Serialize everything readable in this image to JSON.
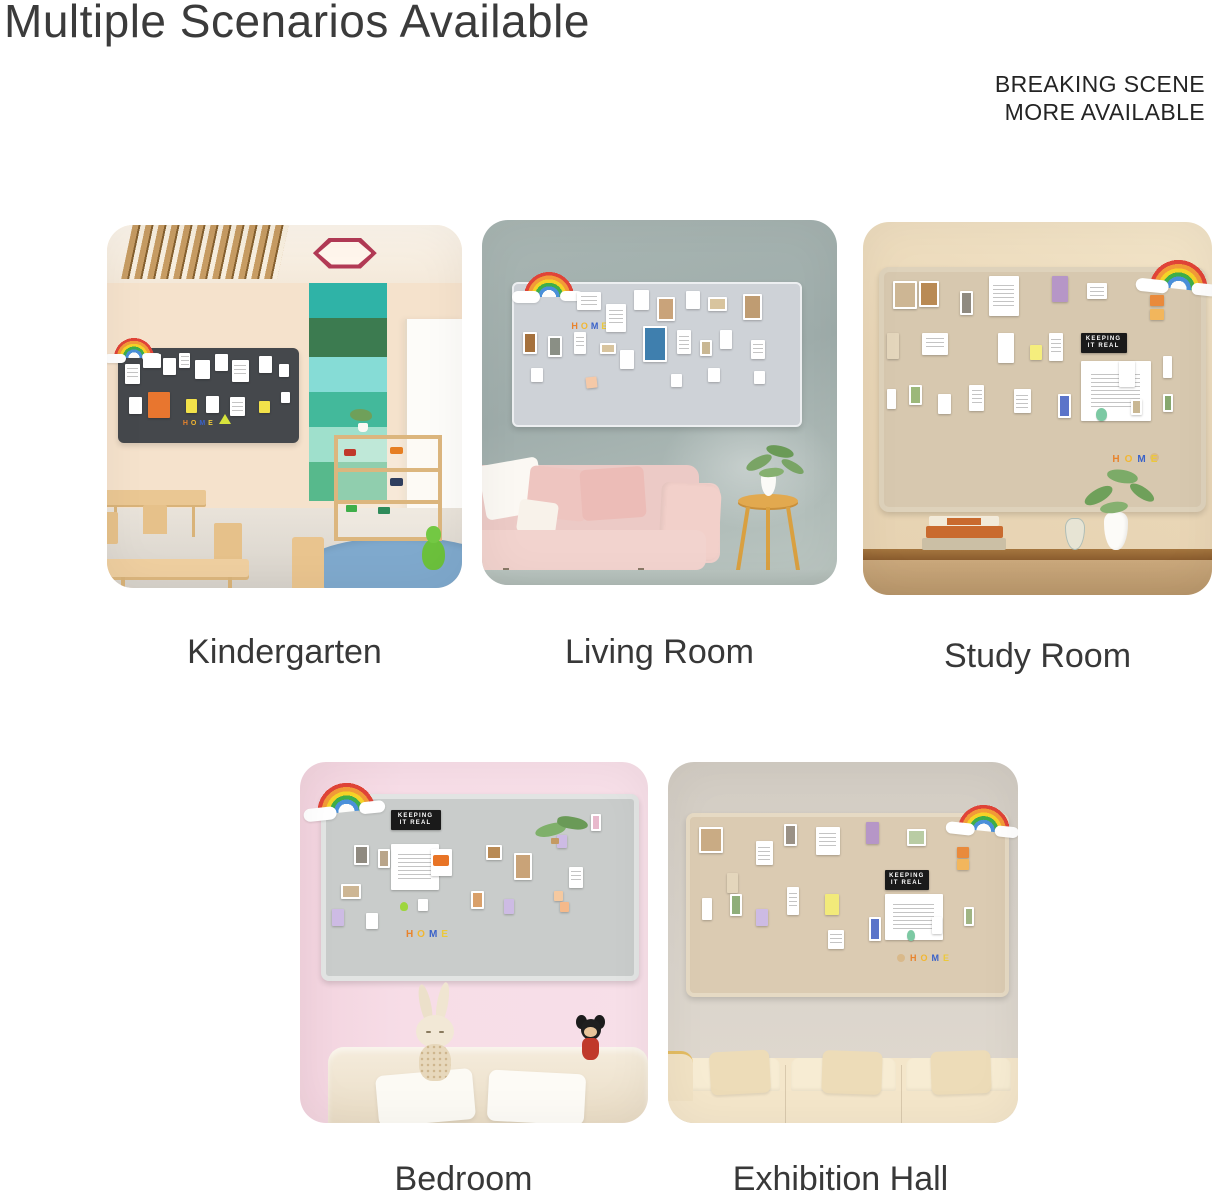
{
  "page": {
    "title": "Multiple Scenarios Available",
    "tagline": [
      "BREAKING SCENE",
      "MORE AVAILABLE"
    ]
  },
  "scenes": [
    {
      "label": "Kindergarten"
    },
    {
      "label": "Living Room"
    },
    {
      "label": "Study Room"
    },
    {
      "label": "Bedroom"
    },
    {
      "label": "Exhibition Hall"
    }
  ],
  "decor": {
    "keeping": [
      "KEEPING",
      "IT REAL"
    ],
    "home": [
      "H",
      "O",
      "M",
      "E"
    ]
  },
  "colors": {
    "title_text": "#3b3b3b",
    "label_text": "#383838",
    "tagline_text": "#242424",
    "background": "#ffffff",
    "rainbow": [
      "#e04438",
      "#f29b38",
      "#f5d327",
      "#3fae49",
      "#4a90d9"
    ],
    "felt_boards": {
      "kindergarten": "#45484c",
      "living_room": "#ced2d7",
      "study_room": "#d7c8af",
      "bedroom": "#c9cccb",
      "exhibition_hall": "#dbcbb2"
    }
  }
}
